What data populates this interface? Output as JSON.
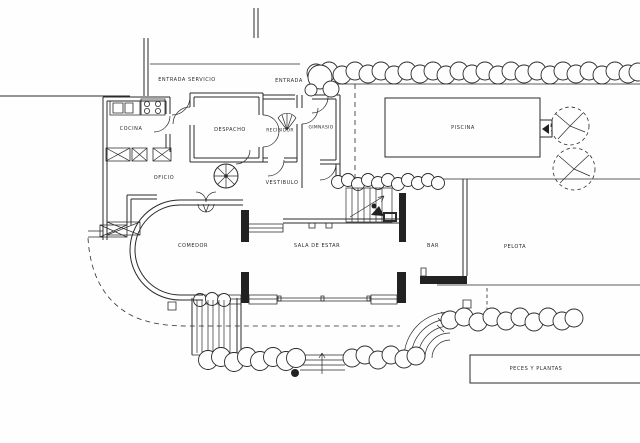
{
  "colors": {
    "line": "#2a2a2a",
    "ink": "#222222",
    "paper": "#fefefe"
  },
  "plan": {
    "type": "architectural-floor-plan",
    "rooms": {
      "entrada_servicio": "ENTRADA SERVICIO",
      "entrada": "ENTRADA",
      "cocina": "COCINA",
      "despacho": "DESPACHO",
      "recibidor": "RECIBIDOR",
      "gimnasio": "GIMNASIO",
      "piscina": "PISCINA",
      "oficio": "OFICIO",
      "vestibulo": "VESTIBULO",
      "comedor": "COMEDOR",
      "sala_de_estar": "SALA  DE  ESTAR",
      "bar": "BAR",
      "pelota": "PELOTA",
      "peces_y_plantas": "PECES  Y  PLANTAS"
    }
  }
}
